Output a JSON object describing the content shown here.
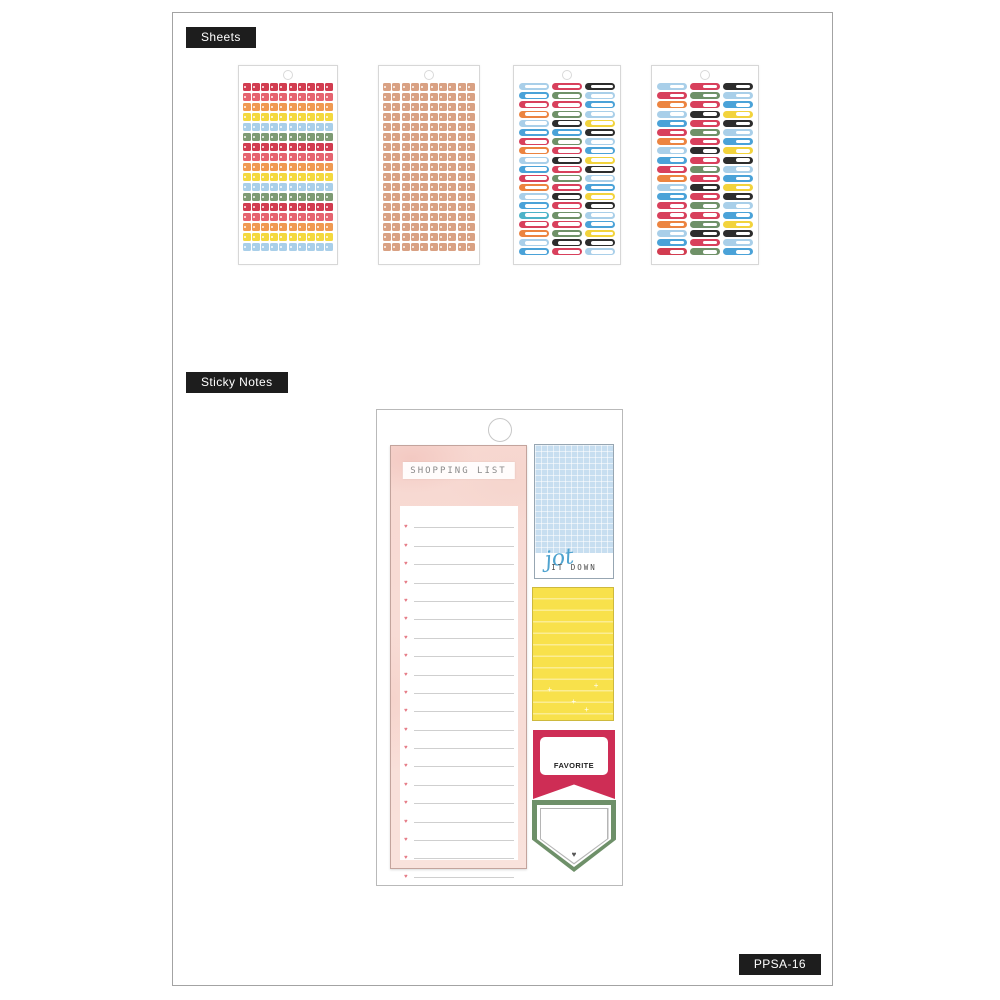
{
  "labels": {
    "sheets": "Sheets",
    "sticky_notes": "Sticky Notes",
    "sku": "PPSA-16"
  },
  "palette": {
    "crimson": "#d23c50",
    "coral": "#e66470",
    "orange": "#f09a52",
    "yellow": "#f4d93e",
    "lightblue": "#a9cfe9",
    "green": "#7e9b74",
    "tan": "#d9a183",
    "blue": "#4aa2d8",
    "teal": "#4db3c8",
    "black": "#2d2d2d",
    "red": "#d8405c",
    "lab_orange": "#ec8440",
    "lab_green": "#6f9168",
    "lab_yellow": "#f2d33c"
  },
  "sheets": [
    {
      "name": "mini-square-sheet-rainbow",
      "type": "dots",
      "cols": 10,
      "row_colors": [
        "crimson",
        "coral",
        "orange",
        "yellow",
        "lightblue",
        "green",
        "crimson",
        "coral",
        "orange",
        "yellow",
        "lightblue",
        "green",
        "crimson",
        "coral",
        "orange",
        "yellow",
        "lightblue"
      ]
    },
    {
      "name": "mini-square-sheet-tan",
      "type": "dots",
      "cols": 10,
      "row_colors": [
        "tan",
        "tan",
        "tan",
        "tan",
        "tan",
        "tan",
        "tan",
        "tan",
        "tan",
        "tan",
        "tan",
        "tan",
        "tan",
        "tan",
        "tan",
        "tan",
        "tan"
      ]
    },
    {
      "name": "label-outline-sheet",
      "type": "labels",
      "style": "outline",
      "rows": [
        [
          "lightblue",
          "red",
          "black"
        ],
        [
          "blue",
          "lab_green",
          "lightblue"
        ],
        [
          "red",
          "red",
          "blue"
        ],
        [
          "lab_orange",
          "lab_green",
          "lightblue"
        ],
        [
          "lightblue",
          "black",
          "lab_yellow"
        ],
        [
          "blue",
          "blue",
          "black"
        ],
        [
          "red",
          "lab_green",
          "lightblue"
        ],
        [
          "lab_orange",
          "red",
          "blue"
        ],
        [
          "lightblue",
          "black",
          "lab_yellow"
        ],
        [
          "blue",
          "red",
          "black"
        ],
        [
          "red",
          "lab_green",
          "lightblue"
        ],
        [
          "lab_orange",
          "red",
          "blue"
        ],
        [
          "lightblue",
          "black",
          "lab_yellow"
        ],
        [
          "blue",
          "red",
          "black"
        ],
        [
          "teal",
          "lab_green",
          "lightblue"
        ],
        [
          "red",
          "red",
          "blue"
        ],
        [
          "lab_orange",
          "lab_green",
          "lab_yellow"
        ],
        [
          "lightblue",
          "black",
          "black"
        ],
        [
          "blue",
          "red",
          "lightblue"
        ]
      ]
    },
    {
      "name": "label-solid-sheet",
      "type": "labels",
      "style": "solid",
      "rows": [
        [
          "lightblue",
          "red",
          "black"
        ],
        [
          "red",
          "lab_green",
          "lightblue"
        ],
        [
          "lab_orange",
          "red",
          "blue"
        ],
        [
          "lightblue",
          "black",
          "lab_yellow"
        ],
        [
          "blue",
          "red",
          "black"
        ],
        [
          "red",
          "lab_green",
          "lightblue"
        ],
        [
          "lab_orange",
          "red",
          "blue"
        ],
        [
          "lightblue",
          "black",
          "lab_yellow"
        ],
        [
          "blue",
          "red",
          "black"
        ],
        [
          "red",
          "lab_green",
          "lightblue"
        ],
        [
          "lab_orange",
          "red",
          "blue"
        ],
        [
          "lightblue",
          "black",
          "lab_yellow"
        ],
        [
          "blue",
          "red",
          "black"
        ],
        [
          "red",
          "lab_green",
          "lightblue"
        ],
        [
          "red",
          "red",
          "blue"
        ],
        [
          "lab_orange",
          "lab_green",
          "lab_yellow"
        ],
        [
          "lightblue",
          "black",
          "black"
        ],
        [
          "blue",
          "red",
          "lightblue"
        ],
        [
          "crimson",
          "lab_green",
          "blue"
        ]
      ]
    }
  ],
  "sticky": {
    "shopping_pad": {
      "title": "SHOPPING LIST",
      "lines": 20,
      "bullet": "♥"
    },
    "jot_note": {
      "script": "jot",
      "caption": "IT DOWN"
    },
    "yellow_note": {
      "sparkle": "+"
    },
    "favorite_note": {
      "label": "FAVORITE"
    },
    "pennant_note": {
      "heart": "♥"
    }
  }
}
